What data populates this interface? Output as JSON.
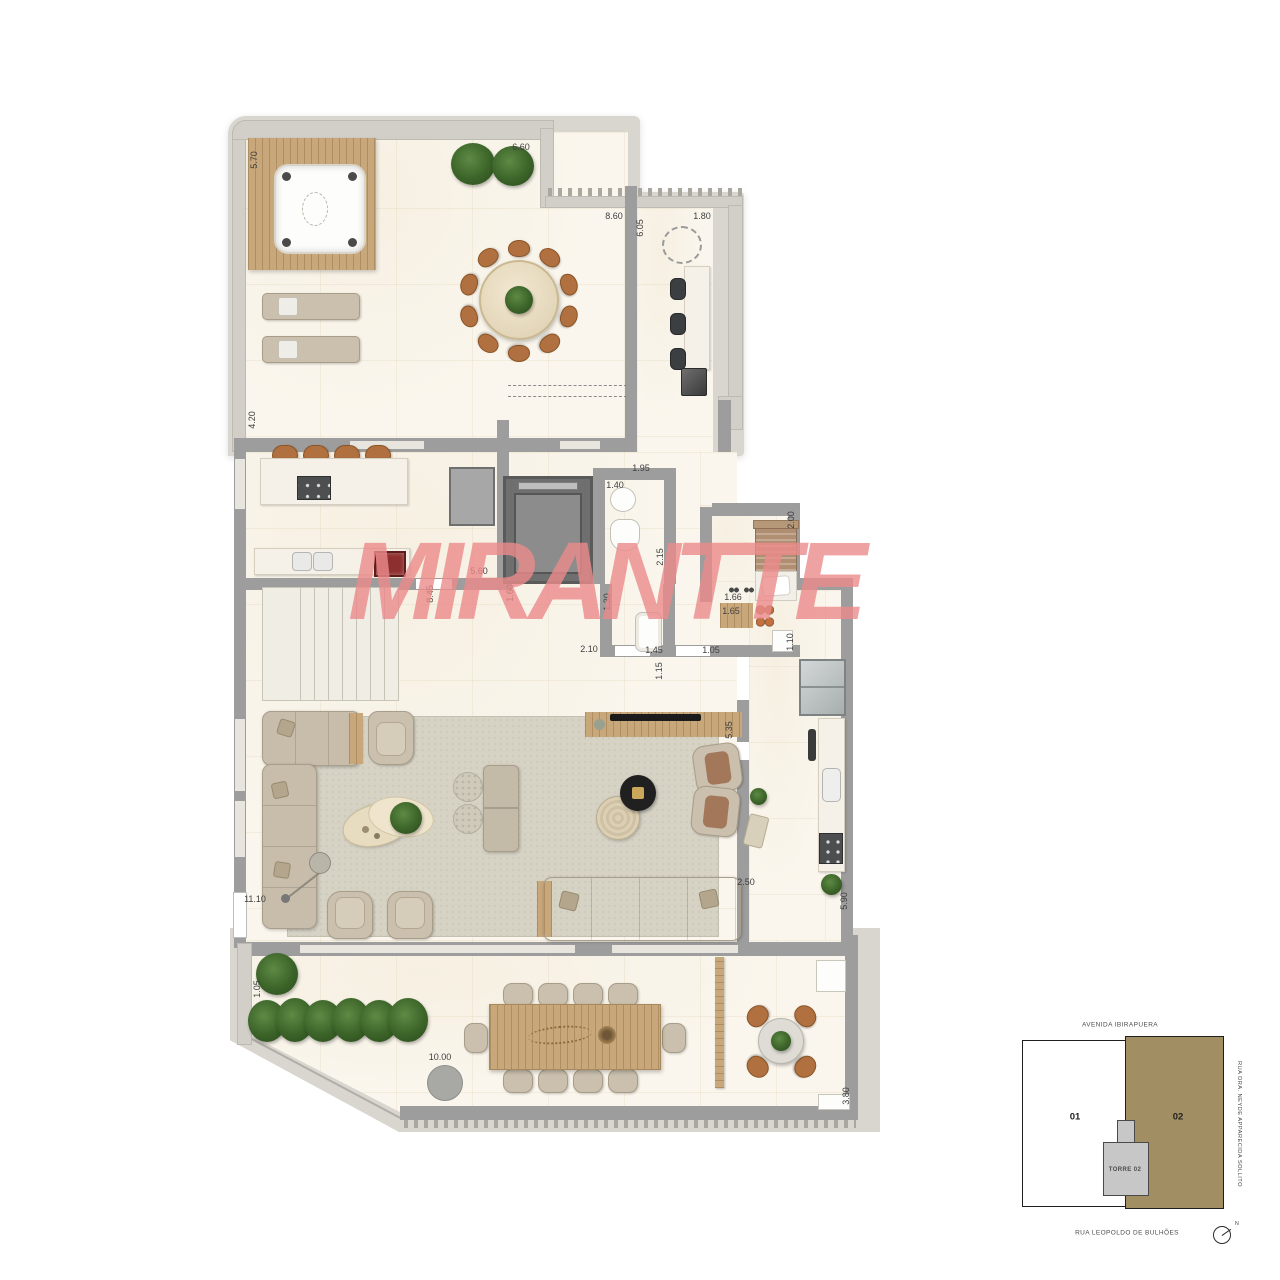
{
  "watermark": {
    "text": "MIRANTTE"
  },
  "colors": {
    "watermark": "#ec8b8b",
    "wall": "#9d9d9d",
    "parapet": "#d9d6cf",
    "wood_deck": "#c8a77b",
    "rug": "#d6d2c4",
    "unit02_fill": "#a28e63",
    "tower_fill": "#c7c7c7",
    "plant_green": "#3c6429",
    "chair_brown": "#b0703f"
  },
  "dimensions": [
    {
      "label": "5.70",
      "x": 254,
      "y": 160,
      "rot": true
    },
    {
      "label": "6.60",
      "x": 521,
      "y": 147,
      "rot": false
    },
    {
      "label": "8.60",
      "x": 614,
      "y": 216,
      "rot": false
    },
    {
      "label": "6.05",
      "x": 640,
      "y": 228,
      "rot": true
    },
    {
      "label": "1.80",
      "x": 702,
      "y": 216,
      "rot": false
    },
    {
      "label": "4.20",
      "x": 252,
      "y": 420,
      "rot": true
    },
    {
      "label": "1.95",
      "x": 641,
      "y": 468,
      "rot": false
    },
    {
      "label": "1.40",
      "x": 615,
      "y": 485,
      "rot": false
    },
    {
      "label": "2.15",
      "x": 660,
      "y": 557,
      "rot": true
    },
    {
      "label": "2.00",
      "x": 791,
      "y": 520,
      "rot": true
    },
    {
      "label": "5.60",
      "x": 479,
      "y": 571,
      "rot": false
    },
    {
      "label": "8.45",
      "x": 430,
      "y": 594,
      "rot": true
    },
    {
      "label": "1.60",
      "x": 510,
      "y": 593,
      "rot": true
    },
    {
      "label": "1.30",
      "x": 607,
      "y": 602,
      "rot": true
    },
    {
      "label": "2.10",
      "x": 589,
      "y": 649,
      "rot": false
    },
    {
      "label": "1.45",
      "x": 654,
      "y": 650,
      "rot": false
    },
    {
      "label": "1.15",
      "x": 659,
      "y": 671,
      "rot": true
    },
    {
      "label": "1.05",
      "x": 711,
      "y": 650,
      "rot": false
    },
    {
      "label": "1.66",
      "x": 733,
      "y": 597,
      "rot": false
    },
    {
      "label": "1.65",
      "x": 731,
      "y": 611,
      "rot": false
    },
    {
      "label": "1.10",
      "x": 790,
      "y": 642,
      "rot": true
    },
    {
      "label": "5.35",
      "x": 729,
      "y": 730,
      "rot": true
    },
    {
      "label": "2.50",
      "x": 746,
      "y": 882,
      "rot": false
    },
    {
      "label": "5.90",
      "x": 844,
      "y": 901,
      "rot": true
    },
    {
      "label": "11.10",
      "x": 255,
      "y": 899,
      "rot": false
    },
    {
      "label": "1.05",
      "x": 257,
      "y": 989,
      "rot": true
    },
    {
      "label": "10.00",
      "x": 440,
      "y": 1057,
      "rot": false
    },
    {
      "label": "3.80",
      "x": 846,
      "y": 1096,
      "rot": true
    }
  ],
  "keyplan": {
    "avenue_top": "AVENIDA IBIRAPUERA",
    "street_right": "RUA DRA. NEYDE APPARECIDA SOLLITO",
    "street_bottom": "RUA LEOPOLDO DE BULHÕES",
    "unit_left": "01",
    "unit_right": "02",
    "tower": "TORRE 02",
    "north": "N"
  }
}
